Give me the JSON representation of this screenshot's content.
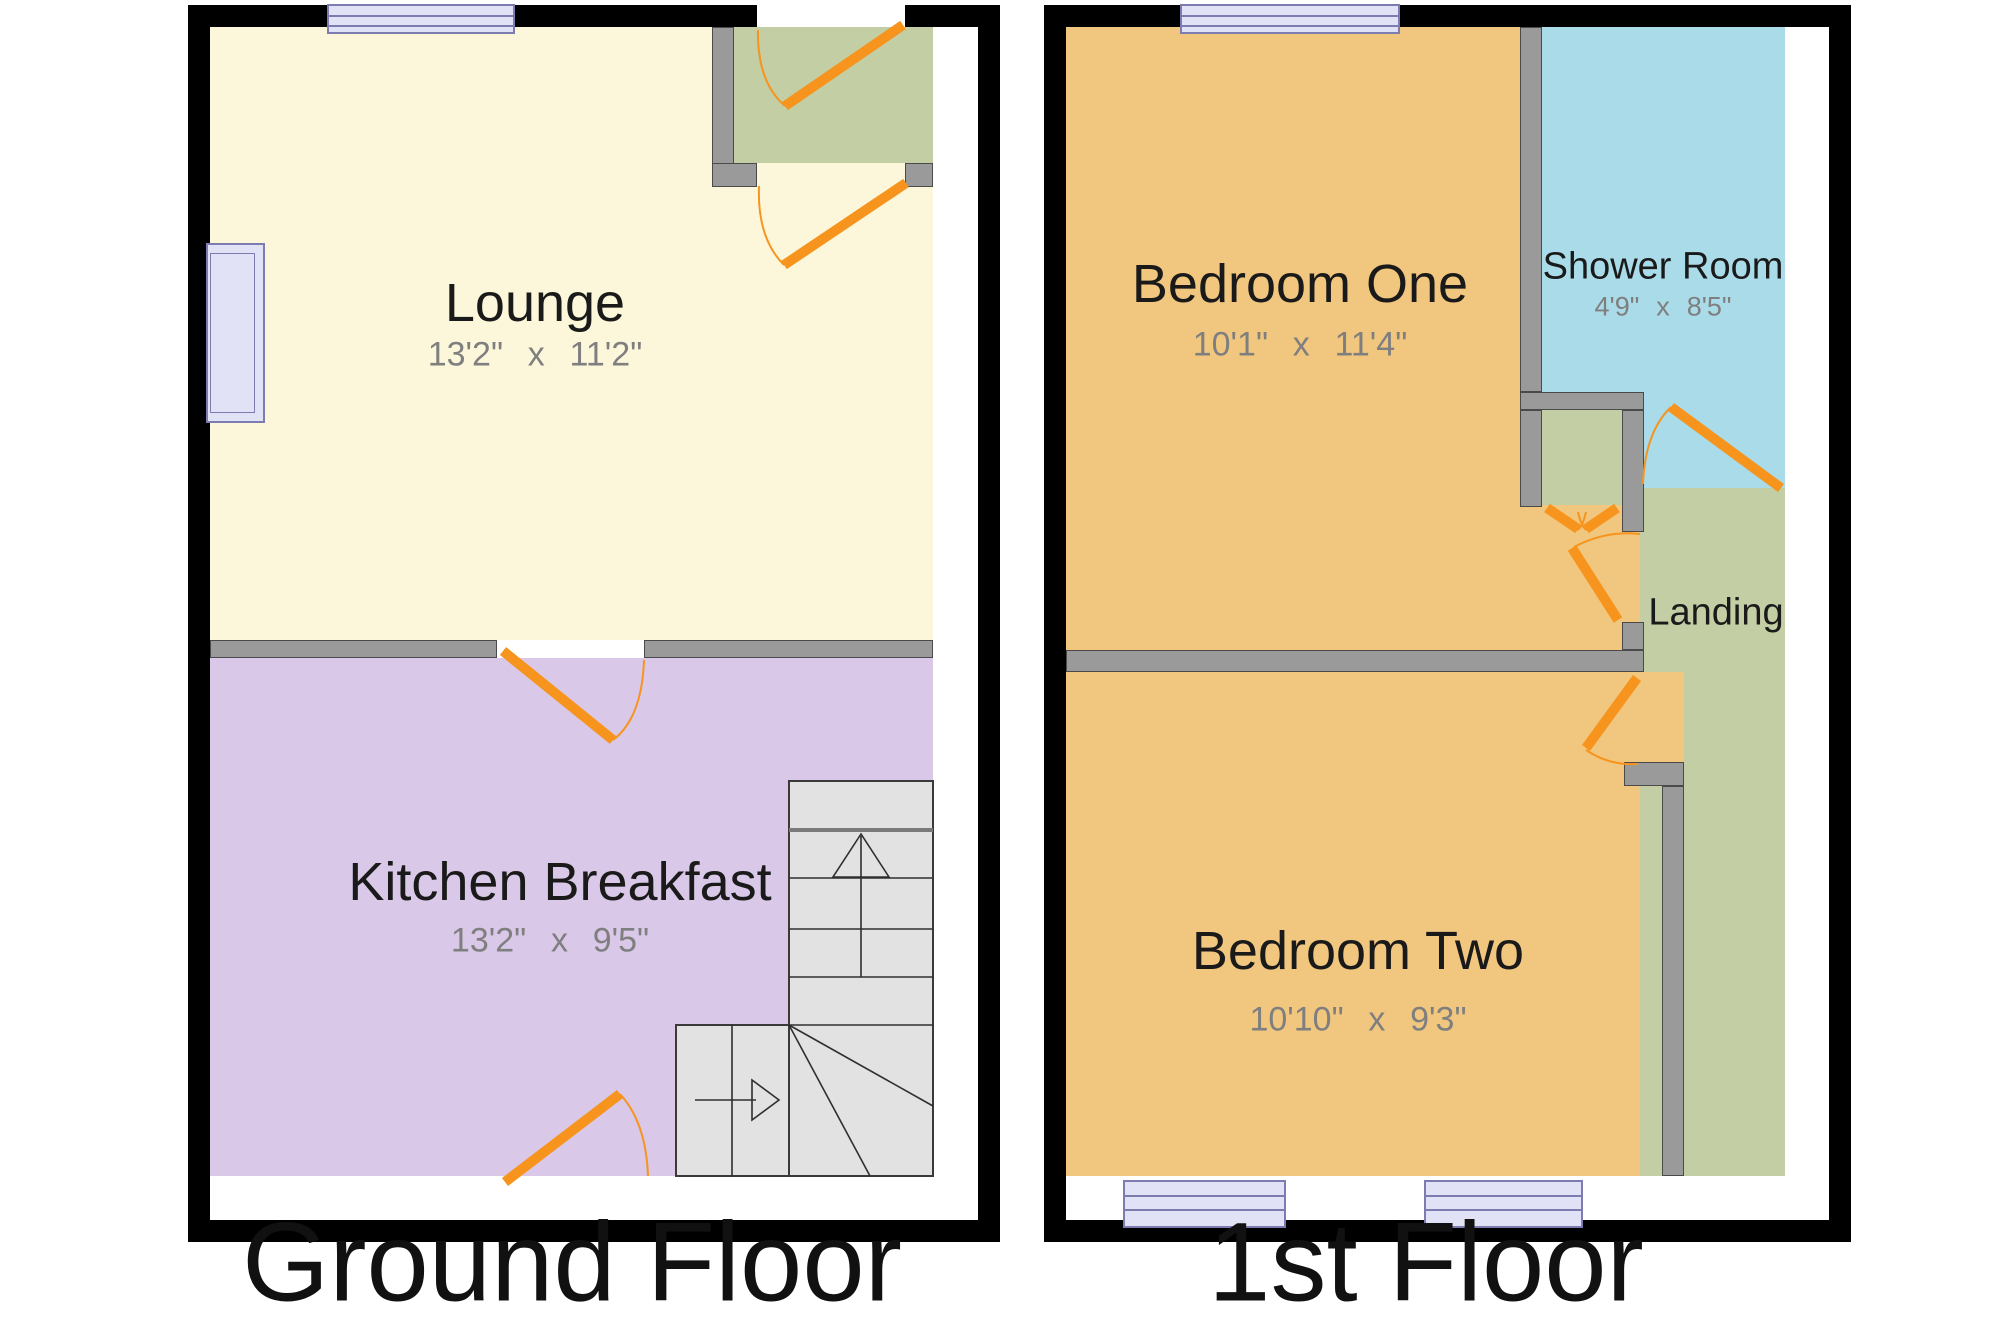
{
  "ground_floor": {
    "label": "Ground Floor",
    "lounge": {
      "name": "Lounge",
      "dims": "13'2\" x 11'2\""
    },
    "kitchen": {
      "name": "Kitchen Breakfast",
      "dims": "13'2\" x 9'5\""
    }
  },
  "first_floor": {
    "label": "1st Floor",
    "bedroom_one": {
      "name": "Bedroom One",
      "dims": "10'1\" x 11'4\""
    },
    "shower_room": {
      "name": "Shower Room",
      "dims": "4'9\" x 8'5\""
    },
    "landing": {
      "name": "Landing"
    },
    "bedroom_two": {
      "name": "Bedroom Two",
      "dims": "10'10\" x 9'3\""
    }
  },
  "colors": {
    "wall": "#000000",
    "internal_wall": "#9A9A9A",
    "lounge": "#FCF7DA",
    "kitchen": "#D9C8E8",
    "porch": "#C3CEA4",
    "bedroom": "#F1C77F",
    "shower": "#A9DBE8",
    "landing": "#C3CEA4",
    "stairs": "#E2E2E2",
    "door": "#F7941D",
    "window_fill": "#E2E2F6",
    "window_border": "#7C7CB0",
    "dim_text": "#7F7F7F",
    "room_text": "#1A1A1A"
  }
}
